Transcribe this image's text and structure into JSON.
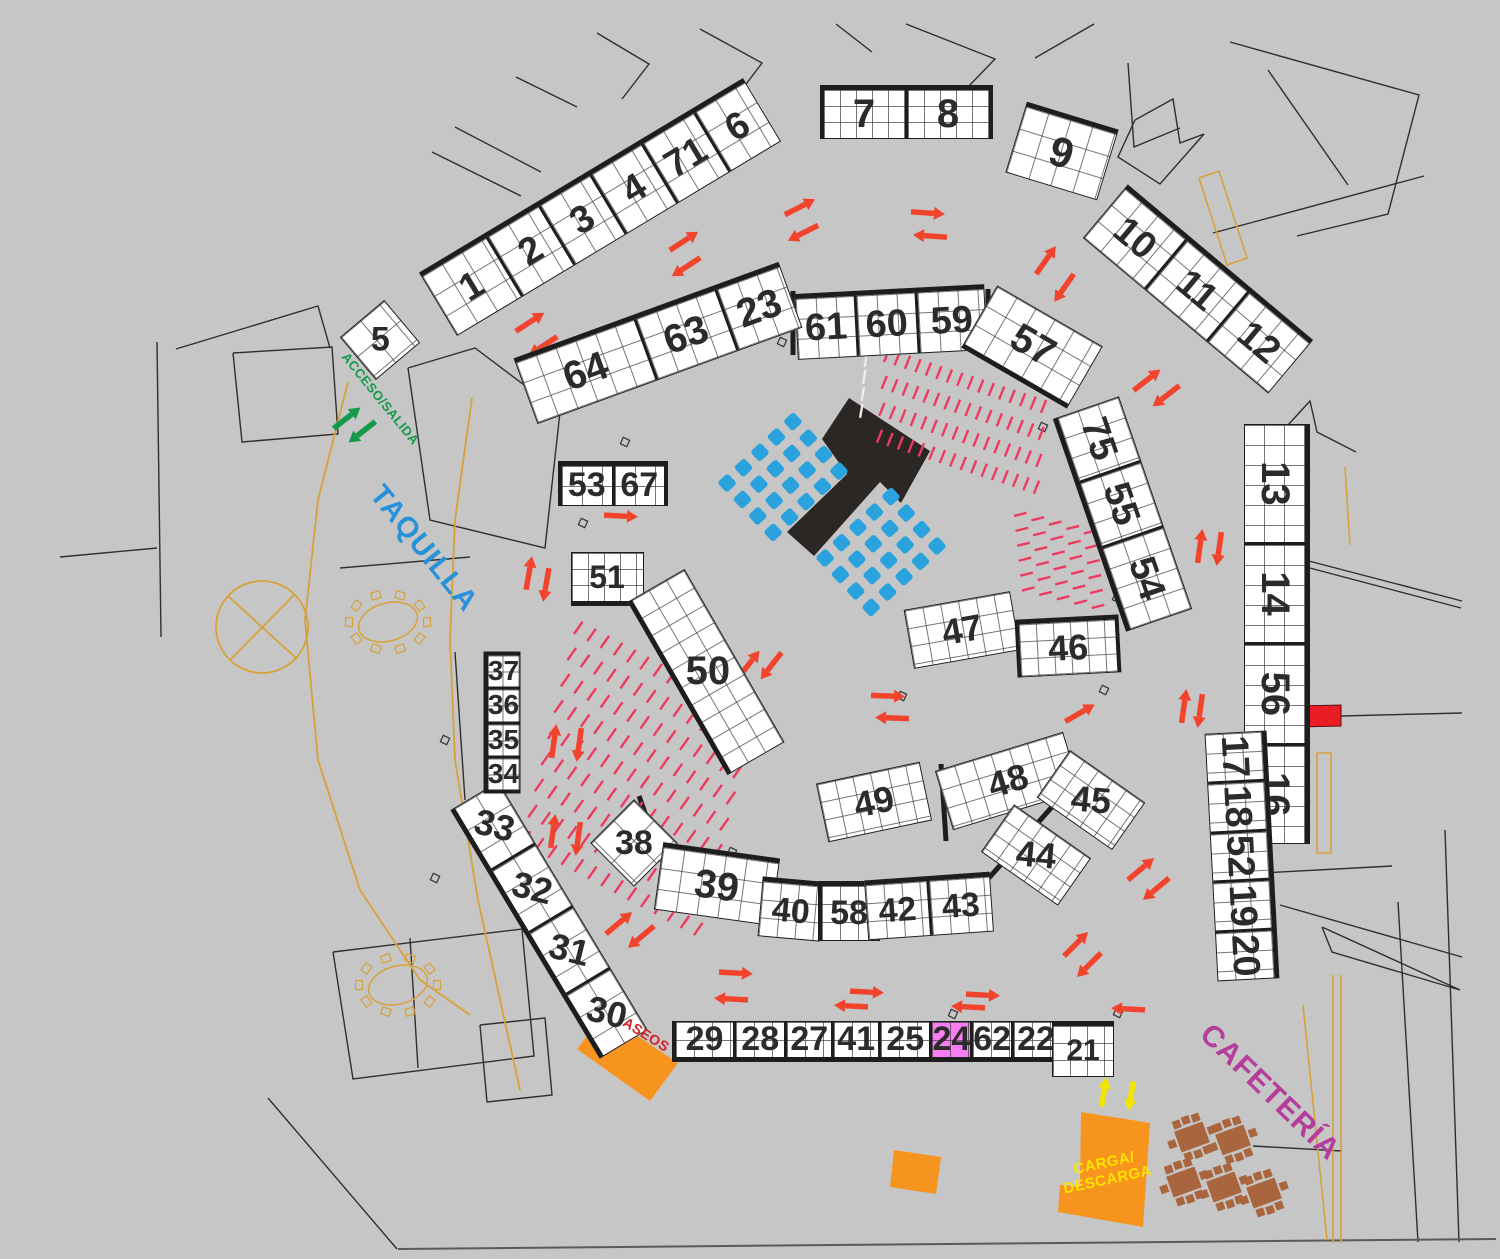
{
  "colors": {
    "background": "#c6c6c6",
    "booth_fill": "#ffffff",
    "booth_border": "#1d1d1d",
    "grid_line": "#5a5a5a",
    "highlight": "#f97df3",
    "arrow_red": "#f2432d",
    "arrow_green": "#15994b",
    "arrow_yellow": "#f2e500",
    "seat_row_pink": "#ee3a60",
    "seat_blue": "#2aa2de",
    "orange_zone": "#f7941e",
    "red_bar": "#ea1c24",
    "stage_black": "#2b2725",
    "tan_line": "#d8a13a",
    "table_brown": "#a9663e",
    "wall_line": "#2f2f2f",
    "label_blue": "#2791d9",
    "label_magenta": "#b53d9b",
    "label_red": "#d42027",
    "label_yellow": "#ffe400"
  },
  "labels": [
    {
      "name": "acceso-salida-label",
      "text": "ACCESO/SALIDA",
      "x": 380,
      "y": 399,
      "rot": 51,
      "size": 13,
      "color": "#15994b",
      "ls": 0.5
    },
    {
      "name": "taquilla-label",
      "text": "TAQUILLA",
      "x": 423,
      "y": 549,
      "rot": 51,
      "size": 29,
      "color": "#2791d9",
      "ls": 1
    },
    {
      "name": "cafeteria-label",
      "text": "CAFETERÍA",
      "x": 1270,
      "y": 1092,
      "rot": 44,
      "size": 30,
      "color": "#b53d9b",
      "ls": 1
    },
    {
      "name": "aseos-label",
      "text": "ASEOS",
      "x": 646,
      "y": 1035,
      "rot": 32,
      "size": 14,
      "color": "#d42027",
      "ls": 0.5
    },
    {
      "name": "carga-descarga-label",
      "text": "CARGA/\nDESCARGA",
      "x": 1106,
      "y": 1172,
      "rot": -12,
      "size": 15,
      "color": "#ffe400",
      "ls": 0.5
    }
  ],
  "strips": [
    {
      "id": "1-6",
      "cx": 600,
      "cy": 207,
      "len": 378,
      "h": 74,
      "rot": -31,
      "rows": 3,
      "thick": "top",
      "fs": 38,
      "booths": [
        {
          "n": "1",
          "f": 1.3
        },
        {
          "n": "2"
        },
        {
          "n": "3"
        },
        {
          "n": "4"
        },
        {
          "n": "71"
        },
        {
          "n": "6"
        }
      ]
    },
    {
      "id": "5",
      "cx": 380,
      "cy": 340,
      "len": 58,
      "h": 56,
      "rot": -40,
      "rows": 2,
      "thick": "none",
      "fs": 34,
      "booths": [
        {
          "n": "5",
          "lr": 40
        }
      ]
    },
    {
      "id": "7-8",
      "cx": 906,
      "cy": 112,
      "len": 173,
      "h": 54,
      "rot": 0,
      "rows": 3,
      "thick": "top",
      "caps": true,
      "fs": 40,
      "booths": [
        {
          "n": "7"
        },
        {
          "n": "8"
        }
      ]
    },
    {
      "id": "9",
      "cx": 1062,
      "cy": 151,
      "len": 96,
      "h": 74,
      "rot": 17,
      "rows": 3,
      "thick": "top",
      "fs": 42,
      "booths": [
        {
          "n": "9"
        }
      ]
    },
    {
      "id": "10-12",
      "cx": 1198,
      "cy": 289,
      "len": 242,
      "h": 70,
      "rot": 40,
      "rows": 3,
      "thick": "top",
      "fs": 38,
      "booths": [
        {
          "n": "10"
        },
        {
          "n": "11"
        },
        {
          "n": "12"
        }
      ]
    },
    {
      "id": "61-59",
      "cx": 891,
      "cy": 322,
      "len": 190,
      "h": 66,
      "rot": -3,
      "rows": 3,
      "thick": "top",
      "fs": 38,
      "booths": [
        {
          "n": "61"
        },
        {
          "n": "60"
        },
        {
          "n": "59",
          "f": 1.15
        }
      ]
    },
    {
      "id": "57",
      "cx": 1032,
      "cy": 347,
      "len": 122,
      "h": 72,
      "rot": 30,
      "rows": 3,
      "thick": "bottom",
      "fs": 40,
      "booths": [
        {
          "n": "57"
        }
      ]
    },
    {
      "id": "64-23",
      "cx": 658,
      "cy": 343,
      "len": 282,
      "h": 70,
      "rot": -20,
      "rows": 3,
      "thick": "top",
      "fs": 40,
      "booths": [
        {
          "n": "64",
          "f": 1.5
        },
        {
          "n": "63"
        },
        {
          "n": "23",
          "f": 0.8
        }
      ]
    },
    {
      "id": "75-54",
      "cx": 1122,
      "cy": 514,
      "len": 225,
      "h": 70,
      "rot": 71,
      "rows": 3,
      "thick": "bottom",
      "fs": 38,
      "booths": [
        {
          "n": "75"
        },
        {
          "n": "55"
        },
        {
          "n": "54",
          "f": 1.3
        }
      ]
    },
    {
      "id": "13-16",
      "cx": 1277,
      "cy": 634,
      "len": 420,
      "h": 66,
      "rot": 90,
      "rows": 3,
      "thick": "top",
      "fs": 40,
      "booths": [
        {
          "n": "13",
          "f": 1.2
        },
        {
          "n": "14"
        },
        {
          "n": "56"
        },
        {
          "n": "16"
        }
      ]
    },
    {
      "id": "17-20",
      "cx": 1242,
      "cy": 856,
      "len": 248,
      "h": 62,
      "rot": 87,
      "rows": 3,
      "thick": "top",
      "fs": 38,
      "booths": [
        {
          "n": "17"
        },
        {
          "n": "18"
        },
        {
          "n": "52"
        },
        {
          "n": "19"
        },
        {
          "n": "20"
        }
      ]
    },
    {
      "id": "53-67",
      "cx": 613,
      "cy": 483,
      "len": 110,
      "h": 45,
      "rot": 0,
      "rows": 2,
      "thick": "top",
      "caps": true,
      "fs": 34,
      "booths": [
        {
          "n": "53"
        },
        {
          "n": "67"
        }
      ]
    },
    {
      "id": "51",
      "cx": 607,
      "cy": 579,
      "len": 73,
      "h": 54,
      "rot": 0,
      "rows": 3,
      "thick": "bottom",
      "fs": 32,
      "booths": [
        {
          "n": "51"
        }
      ]
    },
    {
      "id": "50",
      "cx": 706,
      "cy": 672,
      "len": 200,
      "h": 66,
      "rot": 60,
      "rows": 3,
      "thick": "bottom",
      "fs": 40,
      "booths": [
        {
          "n": "50",
          "lr": -60
        }
      ]
    },
    {
      "id": "47",
      "cx": 962,
      "cy": 630,
      "len": 108,
      "h": 60,
      "rot": -10,
      "rows": 3,
      "thick": "none",
      "fs": 36,
      "booths": [
        {
          "n": "47"
        }
      ]
    },
    {
      "id": "46",
      "cx": 1068,
      "cy": 646,
      "len": 104,
      "h": 58,
      "rot": -3,
      "rows": 3,
      "thick": "top",
      "caps": true,
      "fs": 36,
      "booths": [
        {
          "n": "46"
        }
      ]
    },
    {
      "id": "49",
      "cx": 874,
      "cy": 802,
      "len": 106,
      "h": 60,
      "rot": -12,
      "rows": 3,
      "thick": "none",
      "fs": 36,
      "booths": [
        {
          "n": "49"
        }
      ]
    },
    {
      "id": "48",
      "cx": 1008,
      "cy": 781,
      "len": 134,
      "h": 62,
      "rot": -17,
      "rows": 3,
      "thick": "none",
      "fs": 36,
      "booths": [
        {
          "n": "48"
        }
      ]
    },
    {
      "id": "45",
      "cx": 1091,
      "cy": 800,
      "len": 92,
      "h": 58,
      "rot": 35,
      "rows": 3,
      "thick": "none",
      "fs": 36,
      "booths": [
        {
          "n": "45",
          "lr": -30
        }
      ]
    },
    {
      "id": "44",
      "cx": 1036,
      "cy": 855,
      "len": 94,
      "h": 58,
      "rot": 35,
      "rows": 3,
      "thick": "none",
      "fs": 36,
      "booths": [
        {
          "n": "44",
          "lr": -30
        }
      ]
    },
    {
      "id": "38",
      "cx": 634,
      "cy": 843,
      "len": 62,
      "h": 62,
      "rot": 45,
      "rows": 2,
      "thick": "none",
      "fs": 34,
      "booths": [
        {
          "n": "38",
          "lr": -45
        }
      ]
    },
    {
      "id": "39",
      "cx": 717,
      "cy": 884,
      "len": 118,
      "h": 68,
      "rot": 8,
      "rows": 3,
      "thick": "top",
      "fs": 40,
      "booths": [
        {
          "n": "39"
        }
      ]
    },
    {
      "id": "40",
      "cx": 791,
      "cy": 909,
      "len": 62,
      "h": 60,
      "rot": 5,
      "rows": 3,
      "thick": "top",
      "fs": 34,
      "booths": [
        {
          "n": "40"
        }
      ]
    },
    {
      "id": "58",
      "cx": 849,
      "cy": 911,
      "len": 62,
      "h": 60,
      "rot": 0,
      "rows": 3,
      "thick": "top",
      "caps": true,
      "fs": 34,
      "booths": [
        {
          "n": "58"
        }
      ]
    },
    {
      "id": "42-43",
      "cx": 929,
      "cy": 906,
      "len": 126,
      "h": 60,
      "rot": -4,
      "rows": 3,
      "thick": "top",
      "fs": 34,
      "booths": [
        {
          "n": "42"
        },
        {
          "n": "43"
        }
      ]
    },
    {
      "id": "33-30",
      "cx": 549,
      "cy": 920,
      "len": 290,
      "h": 56,
      "rot": 59,
      "rows": 2,
      "thick": "bottom",
      "fs": 36,
      "booths": [
        {
          "n": "33",
          "lr": -45
        },
        {
          "n": "32",
          "lr": -45
        },
        {
          "n": "31",
          "lr": -45
        },
        {
          "n": "30",
          "lr": -45
        }
      ]
    },
    {
      "id": "37-34",
      "cx": 502,
      "cy": 722,
      "len": 142,
      "h": 37,
      "rot": 90,
      "rows": 2,
      "thick": "bottom",
      "caps": true,
      "fs": 28,
      "booths": [
        {
          "n": "37",
          "lr": -90
        },
        {
          "n": "36",
          "lr": -90
        },
        {
          "n": "35",
          "lr": -90
        },
        {
          "n": "34",
          "lr": -90
        }
      ]
    },
    {
      "id": "29-22",
      "cx": 867,
      "cy": 1041,
      "len": 390,
      "h": 41,
      "rot": 0,
      "rows": 2,
      "thick": "bottom",
      "caps": true,
      "fs": 34,
      "booths": [
        {
          "n": "29",
          "f": 1.3
        },
        {
          "n": "28",
          "f": 1.1
        },
        {
          "n": "27"
        },
        {
          "n": "41"
        },
        {
          "n": "25",
          "f": 1.1
        },
        {
          "n": "24",
          "hl": true,
          "f": 0.8
        },
        {
          "n": "62",
          "f": 0.8
        },
        {
          "n": "22"
        }
      ]
    },
    {
      "id": "21",
      "cx": 1083,
      "cy": 1049,
      "len": 62,
      "h": 56,
      "rot": 0,
      "rows": 3,
      "thick": "top",
      "fs": 30,
      "booths": [
        {
          "n": "21"
        }
      ]
    }
  ],
  "arrows": [
    {
      "x": 800,
      "y": 207,
      "dir": -27
    },
    {
      "x": 803,
      "y": 233,
      "dir": 153
    },
    {
      "x": 928,
      "y": 213,
      "dir": 4
    },
    {
      "x": 930,
      "y": 236,
      "dir": 184
    },
    {
      "x": 1046,
      "y": 260,
      "dir": -55
    },
    {
      "x": 1064,
      "y": 288,
      "dir": 125
    },
    {
      "x": 684,
      "y": 241,
      "dir": -33
    },
    {
      "x": 686,
      "y": 267,
      "dir": 147
    },
    {
      "x": 530,
      "y": 322,
      "dir": -33
    },
    {
      "x": 543,
      "y": 346,
      "dir": 147
    },
    {
      "x": 1147,
      "y": 380,
      "dir": -38
    },
    {
      "x": 1166,
      "y": 396,
      "dir": 142
    },
    {
      "x": 1200,
      "y": 546,
      "dir": -82
    },
    {
      "x": 1219,
      "y": 549,
      "dir": 98
    },
    {
      "x": 529,
      "y": 573,
      "dir": -80
    },
    {
      "x": 546,
      "y": 585,
      "dir": 100
    },
    {
      "x": 621,
      "y": 516,
      "dir": 3
    },
    {
      "x": 749,
      "y": 664,
      "dir": -52
    },
    {
      "x": 771,
      "y": 666,
      "dir": 128
    },
    {
      "x": 888,
      "y": 696,
      "dir": 2
    },
    {
      "x": 892,
      "y": 718,
      "dir": 182
    },
    {
      "x": 1184,
      "y": 706,
      "dir": -82
    },
    {
      "x": 1200,
      "y": 711,
      "dir": 98
    },
    {
      "x": 1080,
      "y": 713,
      "dir": -30
    },
    {
      "x": 554,
      "y": 741,
      "dir": -82
    },
    {
      "x": 579,
      "y": 745,
      "dir": 98
    },
    {
      "x": 553,
      "y": 831,
      "dir": -82
    },
    {
      "x": 578,
      "y": 839,
      "dir": 98
    },
    {
      "x": 619,
      "y": 923,
      "dir": -40
    },
    {
      "x": 641,
      "y": 937,
      "dir": 140
    },
    {
      "x": 736,
      "y": 973,
      "dir": 3
    },
    {
      "x": 731,
      "y": 999,
      "dir": 183
    },
    {
      "x": 867,
      "y": 992,
      "dir": 3
    },
    {
      "x": 851,
      "y": 1006,
      "dir": 183
    },
    {
      "x": 983,
      "y": 995,
      "dir": 3
    },
    {
      "x": 968,
      "y": 1007,
      "dir": 183
    },
    {
      "x": 1128,
      "y": 1009,
      "dir": 183
    },
    {
      "x": 1076,
      "y": 944,
      "dir": -45
    },
    {
      "x": 1089,
      "y": 965,
      "dir": 135
    },
    {
      "x": 1141,
      "y": 869,
      "dir": -40
    },
    {
      "x": 1156,
      "y": 889,
      "dir": 140
    },
    {
      "x": 347,
      "y": 418,
      "dir": -38,
      "c": "#15994b"
    },
    {
      "x": 362,
      "y": 432,
      "dir": 142,
      "c": "#15994b"
    },
    {
      "x": 1104,
      "y": 1092,
      "dir": -80,
      "c": "#f2e500",
      "len": 30
    },
    {
      "x": 1131,
      "y": 1096,
      "dir": 100,
      "c": "#f2e500",
      "len": 30
    }
  ],
  "seat_rows": [
    {
      "x": 884,
      "y": 362,
      "rows": 4,
      "cols": 16,
      "colGap": 11,
      "colAngle": 18,
      "rowGap": 27,
      "rowAngle": 95,
      "segLen": 14,
      "segAngle": -68,
      "color": "#ee3a60"
    },
    {
      "x": 1014,
      "y": 516,
      "rows": 6,
      "cols": 5,
      "colGap": 18,
      "colAngle": 14,
      "rowGap": 15,
      "rowAngle": 84,
      "segLen": 13,
      "segAngle": -14,
      "color": "#ee3a60"
    },
    {
      "x": 574,
      "y": 634,
      "rows": 9,
      "cols": 14,
      "colGap": 15,
      "colAngle": 28,
      "rowGap": 27,
      "rowAngle": 104,
      "segLen": 15,
      "segAngle": -55,
      "color": "#ee3a60"
    },
    {
      "x": 866,
      "y": 350,
      "rows": 1,
      "cols": 5,
      "colGap": 17,
      "colAngle": 95,
      "rowGap": 0,
      "rowAngle": 0,
      "segLen": 14,
      "segAngle": -80,
      "color": "#ececec"
    }
  ],
  "seat_blocks": [
    {
      "cx": 783,
      "cy": 477,
      "rows": 4,
      "cols": 5,
      "gap": 22.5,
      "rot": -43,
      "size": 14,
      "color": "#2aa2de"
    },
    {
      "cx": 881,
      "cy": 552,
      "rows": 4,
      "cols": 5,
      "gap": 22.5,
      "rot": -43,
      "size": 14,
      "color": "#2aa2de"
    }
  ],
  "stage": {
    "points": "849,398 930,451 901,503 880,482 814,556 787,532 847,474 822,439",
    "fill": "#2b2725"
  },
  "shapes": [
    {
      "name": "aseos-zone",
      "points": "604,1014 678,1063 650,1101 577,1049",
      "fill": "#f7941e"
    },
    {
      "name": "carga-descarga-zone",
      "points": "1081,1112 1150,1123 1143,1227 1058,1212 1060,1185 1080,1187",
      "fill": "#f7941e"
    },
    {
      "name": "orange-block",
      "points": "894,1150 941,1157 936,1194 890,1187",
      "fill": "#f7941e"
    },
    {
      "name": "red-bar",
      "points": "1255,707 1341,705 1341,726 1255,728",
      "fill": "#ea1c24",
      "stroke": "#5a1010"
    }
  ],
  "tables_brown": {
    "rot": -20,
    "items": [
      [
        1192,
        1137
      ],
      [
        1233,
        1140
      ],
      [
        1184,
        1182
      ],
      [
        1224,
        1187
      ],
      [
        1264,
        1193
      ]
    ]
  },
  "tables_tan": [
    [
      388,
      622
    ],
    [
      398,
      985
    ]
  ],
  "circle_x": {
    "cx": 262,
    "cy": 627,
    "r": 46,
    "lines": [
      "228,596 297,659",
      "230,660 295,594"
    ]
  },
  "door_squares": [
    [
      782,
      342
    ],
    [
      877,
      337
    ],
    [
      1043,
      427
    ],
    [
      625,
      442
    ],
    [
      583,
      523
    ],
    [
      1117,
      598
    ],
    [
      902,
      696
    ],
    [
      838,
      812
    ],
    [
      732,
      852
    ],
    [
      1104,
      690
    ],
    [
      953,
      1014
    ],
    [
      445,
      740
    ],
    [
      435,
      878
    ],
    [
      1118,
      1013
    ]
  ],
  "walls": [
    {
      "p": "597,33 649,64 622,99"
    },
    {
      "p": "700,29 762,63 737,96"
    },
    {
      "p": "432,152 521,196"
    },
    {
      "p": "455,127 541,172"
    },
    {
      "p": "516,77 577,107"
    },
    {
      "p": "836,24 872,52"
    },
    {
      "p": "906,24 995,59 966,89"
    },
    {
      "p": "1035,58 1094,24"
    },
    {
      "p": "1128,63 1134,147 1180,128"
    },
    {
      "p": "1135,120 1173,99 1180,143 1204,134 1160,184 1118,157 1135,120"
    },
    {
      "p": "1230,42 1419,95 1388,214 1297,236"
    },
    {
      "p": "1268,70 1348,185"
    },
    {
      "p": "1213,233 1424,176"
    },
    {
      "p": "1288,425 1310,401 1317,432 1356,452"
    },
    {
      "p": "1305,560 1462,601"
    },
    {
      "p": "1306,567 1461,608"
    },
    {
      "p": "1243,874 1392,866"
    },
    {
      "p": "1280,905 1462,957"
    },
    {
      "p": "1322,927 1460,990 1332,952 1322,927"
    },
    {
      "p": "1253,1146 1342,1151"
    },
    {
      "p": "1398,902 1418,1242"
    },
    {
      "p": "1445,830 1459,1242"
    },
    {
      "p": "268,1098 397,1249"
    },
    {
      "p": "333,952 522,929 534,1056 353,1079 333,952"
    },
    {
      "p": "480,1025 545,1018 552,1095 487,1102 480,1025"
    },
    {
      "p": "410,938 418,1068"
    },
    {
      "p": "176,349 318,306 330,348"
    },
    {
      "p": "157,342 161,637"
    },
    {
      "p": "60,557 157,548"
    },
    {
      "p": "233,353 332,347 338,434 242,442 233,353"
    },
    {
      "p": "408,368 475,348 560,412 545,548 430,520 408,368"
    },
    {
      "p": "340,568 470,557"
    },
    {
      "p": "455,652 465,800"
    },
    {
      "p": "398,1249 1496,1239",
      "w": 2,
      "c": "#5a5a5a"
    },
    {
      "p": "1341,716 1462,713"
    },
    {
      "p": "793,291 793,355",
      "w": 5,
      "c": "#1d1d1d"
    },
    {
      "p": "988,289 988,353",
      "w": 5,
      "c": "#1d1d1d"
    },
    {
      "p": "941,764 946,841",
      "w": 5,
      "c": "#1d1d1d"
    },
    {
      "p": "988,879 1090,764",
      "w": 5,
      "c": "#1d1d1d"
    },
    {
      "p": "639,796 662,861",
      "w": 5,
      "c": "#1d1d1d"
    },
    {
      "p": "348,382 318,500 305,620 318,760 360,890 420,980 470,1015",
      "c": "#d8a13a",
      "w": 1.8
    },
    {
      "p": "472,398 455,520 450,640 455,760 478,900 520,1090",
      "c": "#d8a13a",
      "w": 1.8
    },
    {
      "p": "1333,975 1333,1243",
      "c": "#d8a13a",
      "w": 1.6
    },
    {
      "p": "1341,975 1341,1243",
      "c": "#d8a13a",
      "w": 1.6
    },
    {
      "p": "1303,1005 1327,1240",
      "c": "#d8a13a",
      "w": 1.6
    },
    {
      "p": "1199,178 1219,171 1247,258 1227,265 1199,178",
      "c": "#d8a13a",
      "w": 1.6
    },
    {
      "p": "1317,753 1331,753 1331,853 1317,853 1317,753",
      "c": "#d8a13a",
      "w": 1.6
    },
    {
      "p": "1345,467 1350,545",
      "c": "#d8a13a",
      "w": 1.6
    }
  ]
}
